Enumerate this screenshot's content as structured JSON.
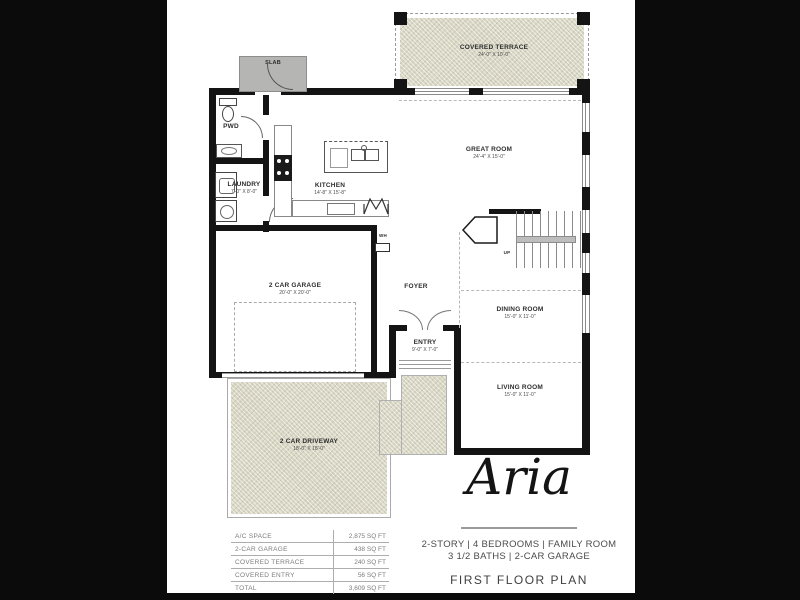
{
  "page": {
    "background_color": "#0b0b0b",
    "paper_color": "#ffffff",
    "wall_color": "#141414",
    "texture_color": "#d9d7c4"
  },
  "plan": {
    "rooms": {
      "covered_terrace": {
        "label": "COVERED TERRACE",
        "dims": "24'-0\" X 10'-0\""
      },
      "great_room": {
        "label": "GREAT ROOM",
        "dims": "24'-4\" X 15'-0\""
      },
      "kitchen": {
        "label": "KITCHEN",
        "dims": "14'-8\" X 15'-8\""
      },
      "laundry": {
        "label": "LAUNDRY",
        "dims": "7'-0\" X 8'-0\""
      },
      "pwd": {
        "label": "PWD"
      },
      "slab": {
        "label": "SLAB"
      },
      "wh": {
        "label": "WH"
      },
      "garage": {
        "label": "2 CAR GARAGE",
        "dims": "20'-0\" X 20'-0\""
      },
      "foyer": {
        "label": "FOYER"
      },
      "entry": {
        "label": "ENTRY",
        "dims": "9'-0\" X 7'-0\""
      },
      "dining": {
        "label": "DINING ROOM",
        "dims": "15'-0\" X 11'-0\""
      },
      "living": {
        "label": "LIVING ROOM",
        "dims": "15'-0\" X 11'-0\""
      },
      "driveway": {
        "label": "2 CAR DRIVEWAY",
        "dims": "18'-0\" X 18'-0\""
      },
      "stairs_up": {
        "label": "UP"
      }
    }
  },
  "area_table": {
    "rows": [
      {
        "label": "A/C SPACE",
        "value": "2,875 SQ FT"
      },
      {
        "label": "2-CAR GARAGE",
        "value": "438 SQ FT"
      },
      {
        "label": "COVERED TERRACE",
        "value": "240 SQ FT"
      },
      {
        "label": "COVERED ENTRY",
        "value": "56 SQ FT"
      },
      {
        "label": "TOTAL",
        "value": "3,609 SQ FT"
      }
    ]
  },
  "title_block": {
    "model_name": "Aria",
    "specs_line1": "2-STORY   |   4 BEDROOMS   | FAMILY ROOM",
    "specs_line2": "3 1/2 BATHS   |   2-CAR GARAGE",
    "plan_title": "FIRST FLOOR PLAN"
  }
}
